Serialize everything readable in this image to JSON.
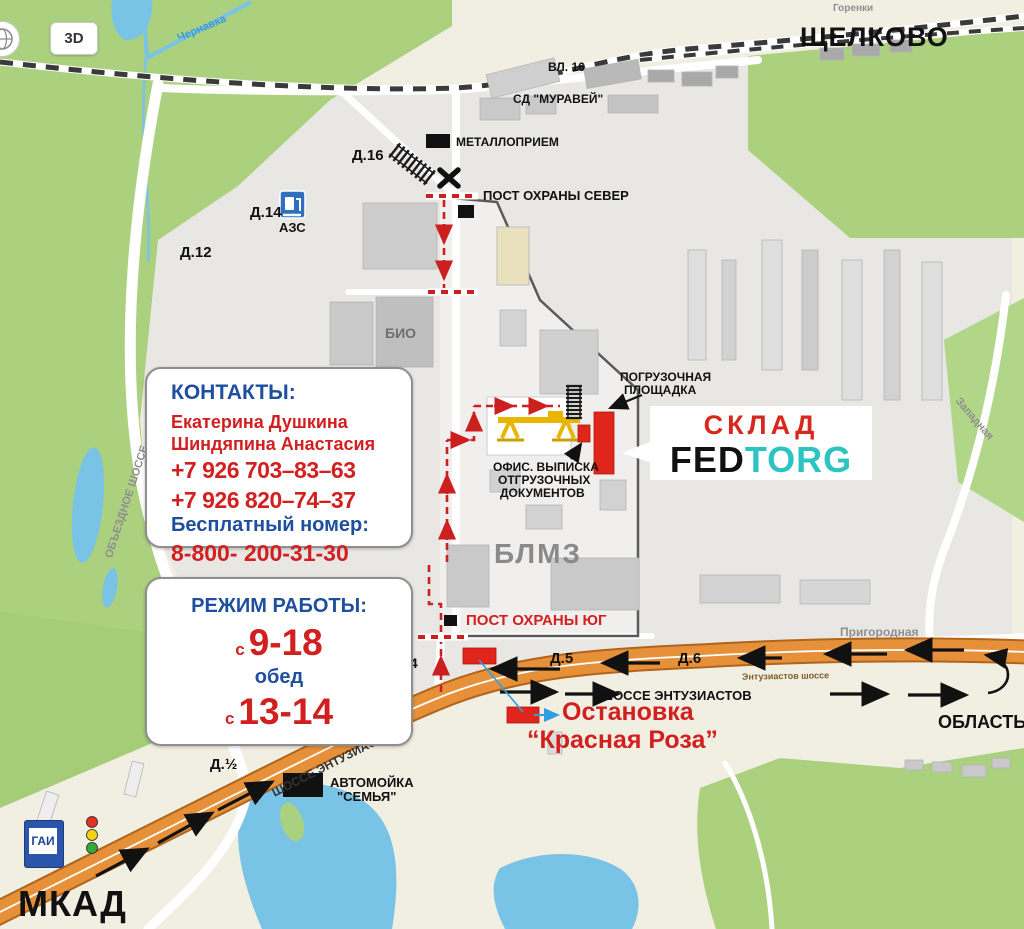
{
  "controls": {
    "btn_3d": "3D"
  },
  "areas": {
    "city": "ЩЕЛКОВО",
    "oblast": "ОБЛАСТЬ",
    "mkad": "МКАД"
  },
  "streets": {
    "entuz_main": "ШОССЕ ЭНТУЗИАСТОВ",
    "entuz_diag": "ШОССЕ ЭНТУЗИАСТОВ",
    "entuz_onroad": "Энтузиастов шоссе",
    "obezdnoe": "ОБЪЕЗДНОЕ ШОССЕ",
    "prigorodnaya": "Пригородная",
    "zapadnaya": "Западная",
    "chernavka": "Чернавка",
    "gorenki": "Горенки"
  },
  "houses": {
    "d16": "Д.16",
    "d14": "Д.14",
    "d12": "Д.12",
    "d4": "Д.4",
    "d5": "Д.5",
    "d6": "Д.6",
    "d_half": "Д.½",
    "vl16": "ВЛ. 16",
    "sd_muravei": "СД \"МУРАВЕЙ\"",
    "bio": "БИО",
    "blmz": "БЛМЗ"
  },
  "poi": {
    "metallopriem": "МЕТАЛЛОПРИЕМ",
    "post_north": "ПОСТ ОХРАНЫ СЕВЕР",
    "post_south": "ПОСТ ОХРАНЫ ЮГ",
    "azs": "АЗС",
    "gai": "ГАИ",
    "loading_1": "ПОГРУЗОЧНАЯ",
    "loading_2": "ПЛОЩАДКА",
    "office_1": "ОФИС. ВЫПИСКА",
    "office_2": "ОТГРУЗОЧНЫХ",
    "office_3": "ДОКУМЕНТОВ",
    "carwash_1": "АВТОМОЙКА",
    "carwash_2": "\"СЕМЬЯ\"",
    "busstop_1": "Остановка",
    "busstop_2": "“Красная Роза”"
  },
  "logo": {
    "sklad": "СКЛАД",
    "fed": "FED",
    "torg": "TORG"
  },
  "contacts": {
    "title": "КОНТАКТЫ:",
    "names": [
      "Екатерина Душкина",
      "Шиндяпина Анастасия"
    ],
    "phone1": "+7 926 703–83–63",
    "phone2": "+7 926 820–74–37",
    "free_label": "Бесплатный номер:",
    "free_phone": "8-800- 200-31-30"
  },
  "schedule": {
    "title": "РЕЖИМ РАБОТЫ:",
    "prefix": "с",
    "hours": "9-18",
    "lunch": "обед",
    "prefix2": "с",
    "lunch_hours": "13-14"
  },
  "colors": {
    "accent_red": "#d21f1f",
    "accent_blue": "#1d4f9e",
    "logo_teal": "#2cc3c3",
    "highway_orange": "#e6913a",
    "map_green": "#abd07e",
    "water_blue": "#79c3e6"
  }
}
